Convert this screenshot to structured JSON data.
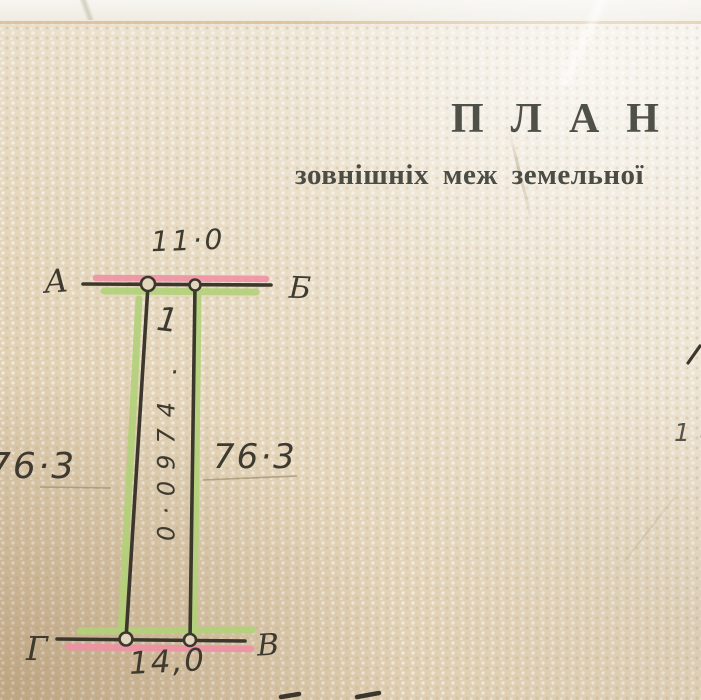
{
  "document": {
    "title": "ПЛАН",
    "subtitle": "зовнішніх меж земельної"
  },
  "plan": {
    "corners": {
      "top_left": "А",
      "top_right": "Б",
      "bottom_right": "В",
      "bottom_left": "Г"
    },
    "side_lengths": {
      "top": "11·0",
      "left": "76·3",
      "right": "76·3",
      "bottom": "14,0"
    },
    "plot_number": "1",
    "plot_number_mark": "·",
    "area_value": "0·0974",
    "margin_note": "18"
  },
  "colors": {
    "paper": "#ece1cb",
    "ink": "#3e3a2f",
    "printed_text": "#4f5048",
    "highlight_green": "#b2d179",
    "highlight_pink": "#f08fa4"
  }
}
